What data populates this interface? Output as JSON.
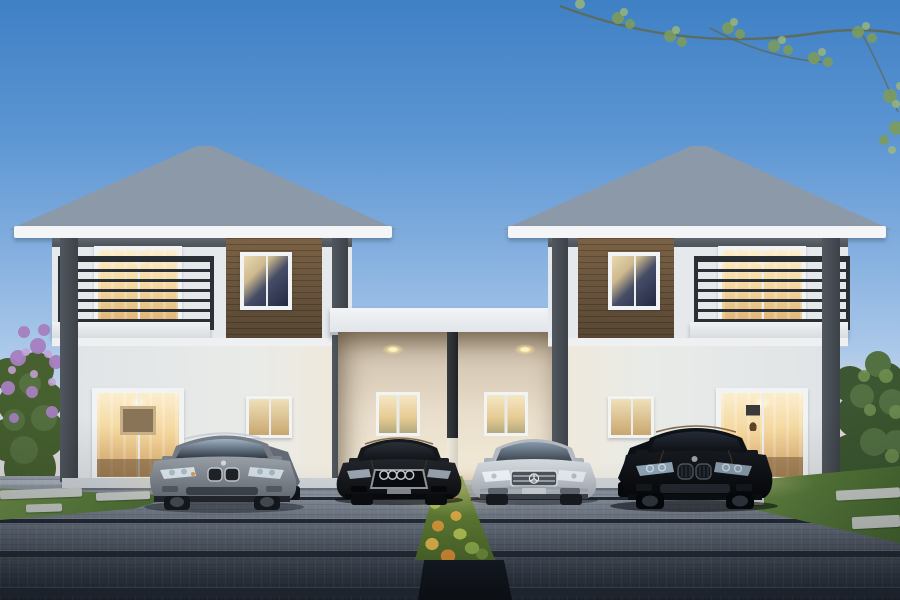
{
  "scene": {
    "type": "architectural-rendering",
    "description": "Dusk 3D rendering of twin two-storey duplex houses with grey hip roofs joined by a shared central double carport; four sedans parked on a block-paved driveway with a central flowering shrub strip, lawns, stepping stones, a purple flowering bush on the left and green trees on the right",
    "time_of_day": "dusk",
    "counts": {
      "houses": 2,
      "storeys": 2,
      "cars": 4,
      "carport_bays": 2,
      "carport_downlights": 2,
      "carport_windows": 2,
      "balconies": 2
    },
    "sky": {
      "label": "clear dusk sky with overhanging leafy branches top right",
      "top_color": "#3f80c5",
      "horizon_color": "#efe6de"
    },
    "left_house": {
      "label": "left two-storey house with grey hip roof, dark-framed white walls, brown wood-clad panel, balcony with dark metal railing and warm-lit floor-to-ceiling windows"
    },
    "right_house": {
      "label": "right two-storey house, mirror image of the left house, with brown wood-clad panel, balcony and warm-lit windows"
    },
    "carport": {
      "label": "shared central double carport with flat white roof slab, warm-lit interior, two recessed ceiling downlights, two small rear windows and a central dark post"
    },
    "cars": [
      {
        "id": "car-grey-sedan",
        "label": "grey BMW-style sedan parked in front of the left house",
        "color": "#8a9098"
      },
      {
        "id": "car-black-sedan-left-bay",
        "label": "black Audi-style sedan with four-ring grille parked in the left carport bay",
        "color": "#15181c"
      },
      {
        "id": "car-silver-sedan-right-bay",
        "label": "silver Mercedes-style sedan with star grille parked in the right carport bay",
        "color": "#c6cbd1"
      },
      {
        "id": "car-black-sedan-right",
        "label": "black BMW-style sedan parked in front of the right house",
        "color": "#0d1014"
      }
    ],
    "landscaping": {
      "driveway": "grey interlocking paver driveway with dark expansion seams, darkening toward the foreground",
      "shrub_strip": "central strip of green shrubs with orange and yellow flowers running between the carport bays",
      "left_garden": "purple flowering bush and lawn with light stepping stones on the left",
      "right_garden": "green trees and hedge with lawn and stepping stones on the right"
    },
    "palette": {
      "roof": "#8a97a8",
      "wall": "#e6e9ec",
      "wood_panel": "#6b5840",
      "dark_trim": "#474d54",
      "warm_window_light": "#f4d79e",
      "carport_interior": "#e9decb",
      "driveway_light": "#9aa3ae",
      "driveway_dark": "#222833",
      "grass": "#5d8040",
      "shrub_flowers": "#e0ad42",
      "purple_bush": "#a77fc0"
    }
  }
}
